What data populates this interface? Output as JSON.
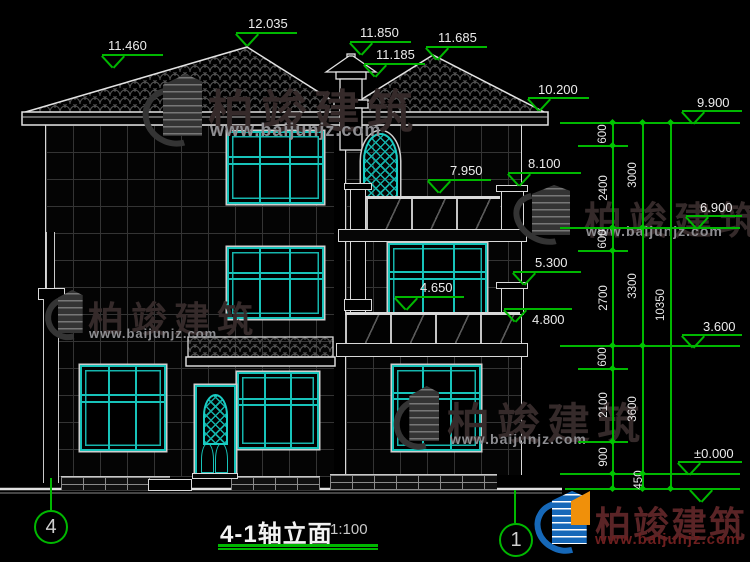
{
  "title": {
    "text": "4-1轴立面",
    "scale": "1:100"
  },
  "axes": {
    "left": "4",
    "right": "1"
  },
  "elevation_markers": [
    {
      "label": "11.460"
    },
    {
      "label": "12.035"
    },
    {
      "label": "11.850"
    },
    {
      "label": "11.185"
    },
    {
      "label": "11.685"
    },
    {
      "label": "10.200"
    },
    {
      "label": "9.900"
    },
    {
      "label": "8.100"
    },
    {
      "label": "7.950"
    },
    {
      "label": "6.900"
    },
    {
      "label": "5.300"
    },
    {
      "label": "4.650"
    },
    {
      "label": "4.800"
    },
    {
      "label": "3.600"
    },
    {
      "label": "±0.000"
    }
  ],
  "dimensions": {
    "small": [
      "600",
      "2400",
      "600",
      "2700",
      "600",
      "2100",
      "900",
      "450"
    ],
    "floors": [
      "3000",
      "3300",
      "3600"
    ],
    "total": "10350"
  },
  "watermark": {
    "brand": "柏竣建筑",
    "url": "www.baijunjz.com"
  },
  "colors": {
    "cad_green": "#00b800",
    "window_cyan": "#17c3ba",
    "logo_blue": "#1668b8",
    "logo_orange": "#f0900a"
  }
}
